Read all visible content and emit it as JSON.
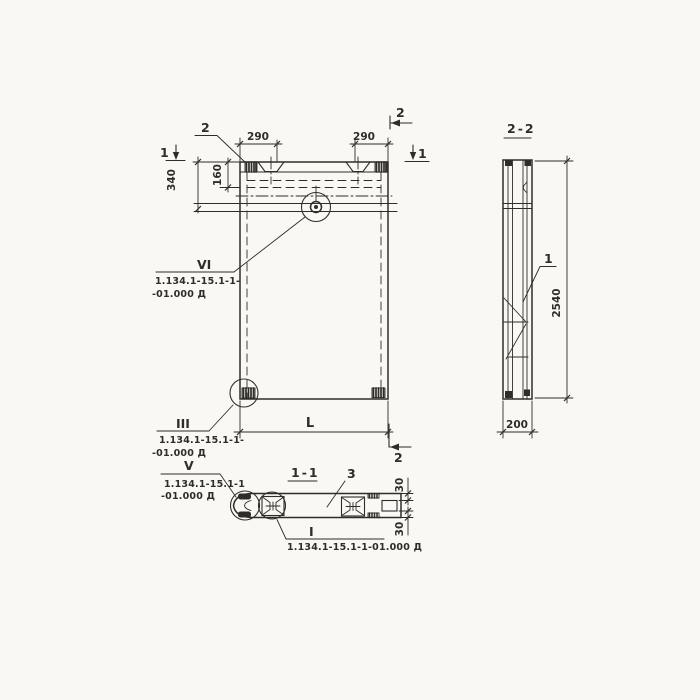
{
  "colors": {
    "paper": "#f9f8f5",
    "ink": "#2f2d2a"
  },
  "front_view": {
    "dims": {
      "d290_left": "290",
      "d290_right": "290",
      "d340": "340",
      "d160": "160",
      "length": "L"
    },
    "section_marks": {
      "s2_top_left": "2",
      "s2_top_right": "2",
      "s2_bottom_right": "2",
      "s1_left": "1",
      "s1_right": "1"
    }
  },
  "side_view": {
    "title": "2-2",
    "dims": {
      "height": "2540",
      "width": "200"
    },
    "callout": "1"
  },
  "plan_view": {
    "title": "1-1",
    "callout": "3",
    "dims": {
      "flange_top": "30",
      "flange_bottom": "30"
    }
  },
  "detail_callouts": {
    "vi": {
      "mark": "VI",
      "ref1": "1.134.1-15.1-1-",
      "ref2": "-01.000 Д"
    },
    "iii": {
      "mark": "III",
      "ref1": "1.134.1-15.1-1-",
      "ref2": "-01.000 Д"
    },
    "v": {
      "mark": "V",
      "ref1": "1.134.1-15.1-1",
      "ref2": "-01.000 Д"
    },
    "i": {
      "mark": "I",
      "ref1": "1.134.1-15.1-1-01.000 Д"
    }
  }
}
